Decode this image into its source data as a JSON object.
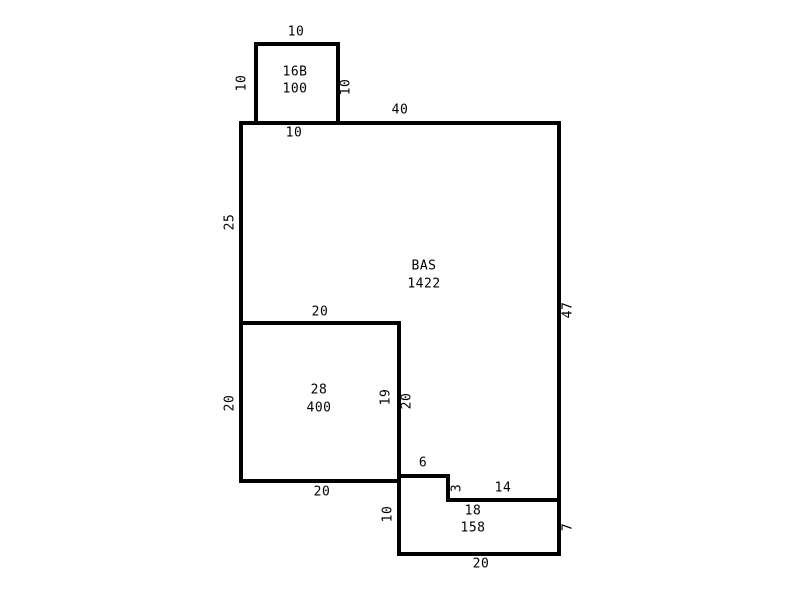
{
  "canvas": {
    "background": "#ffffff",
    "line_color": "#000000"
  },
  "areas": [
    {
      "name": "16B",
      "sqft": "100"
    },
    {
      "name": "BAS",
      "sqft": "1422"
    },
    {
      "name": "28",
      "sqft": "400"
    },
    {
      "name": "18",
      "sqft": "158"
    }
  ],
  "dims": {
    "a16b_top": "10",
    "a16b_left": "10",
    "a16b_right": "10",
    "a16b_base": "10",
    "bas_top": "40",
    "bas_left_upper": "25",
    "bas_right": "47",
    "r28_top": "20",
    "r28_left": "20",
    "r28_right_inner": "19",
    "r28_right_outer": "20",
    "r28_bottom": "20",
    "step_top": "6",
    "step_side": "3",
    "step_run": "14",
    "a18_left": "10",
    "a18_right": "7",
    "a18_bottom": "20"
  }
}
